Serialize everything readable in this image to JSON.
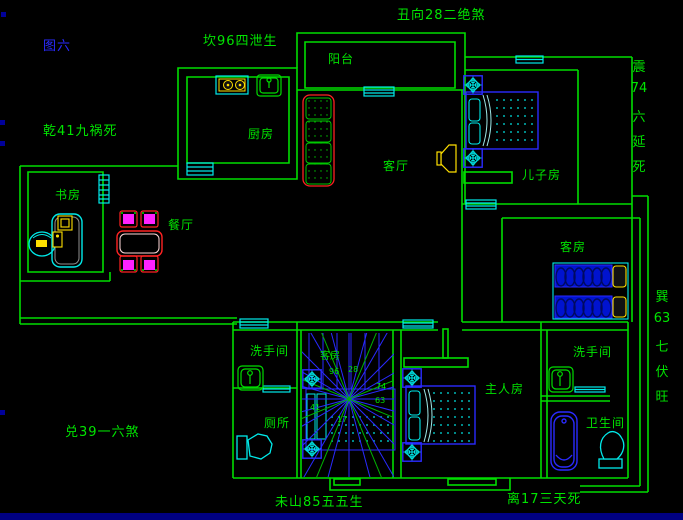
{
  "figure_label": "图六",
  "annotations": {
    "top": "丑向28二绝煞",
    "top_left": "坎96四泄生",
    "left": "乾41九祸死",
    "bottom_left": "兑39一六煞",
    "bottom_center": "未山85五五生",
    "bottom_right": "离17三天死",
    "right_upper_lines": [
      "震",
      "74",
      "六",
      "延",
      "死"
    ],
    "right_lower_lines": [
      "巽",
      "63",
      "七",
      "伏",
      "旺"
    ]
  },
  "rooms": {
    "balcony": "阳台",
    "kitchen": "厨房",
    "living_room": "客厅",
    "sons_room": "儿子房",
    "study": "书房",
    "dining_room": "餐厅",
    "guest_room": "客房",
    "middle_room": "客房",
    "washroom_left": "洗手间",
    "toilet": "厕所",
    "master_room": "主人房",
    "washroom_right": "洗手间",
    "bathroom": "卫生间"
  },
  "compass_numbers": {
    "n": "96",
    "ne": "28",
    "e": "74",
    "se": "63",
    "w": "41",
    "s": "17"
  },
  "colors": {
    "wall_green": "#00dd00",
    "window_cyan": "#00eaea",
    "furniture_blue": "#2a2aff",
    "accent_yellow": "#ffe000",
    "accent_red": "#ff2222",
    "accent_magenta": "#ff22ff",
    "text_green": "#00e400",
    "figure_blue": "#2a2aff",
    "status_navy": "#000082"
  }
}
